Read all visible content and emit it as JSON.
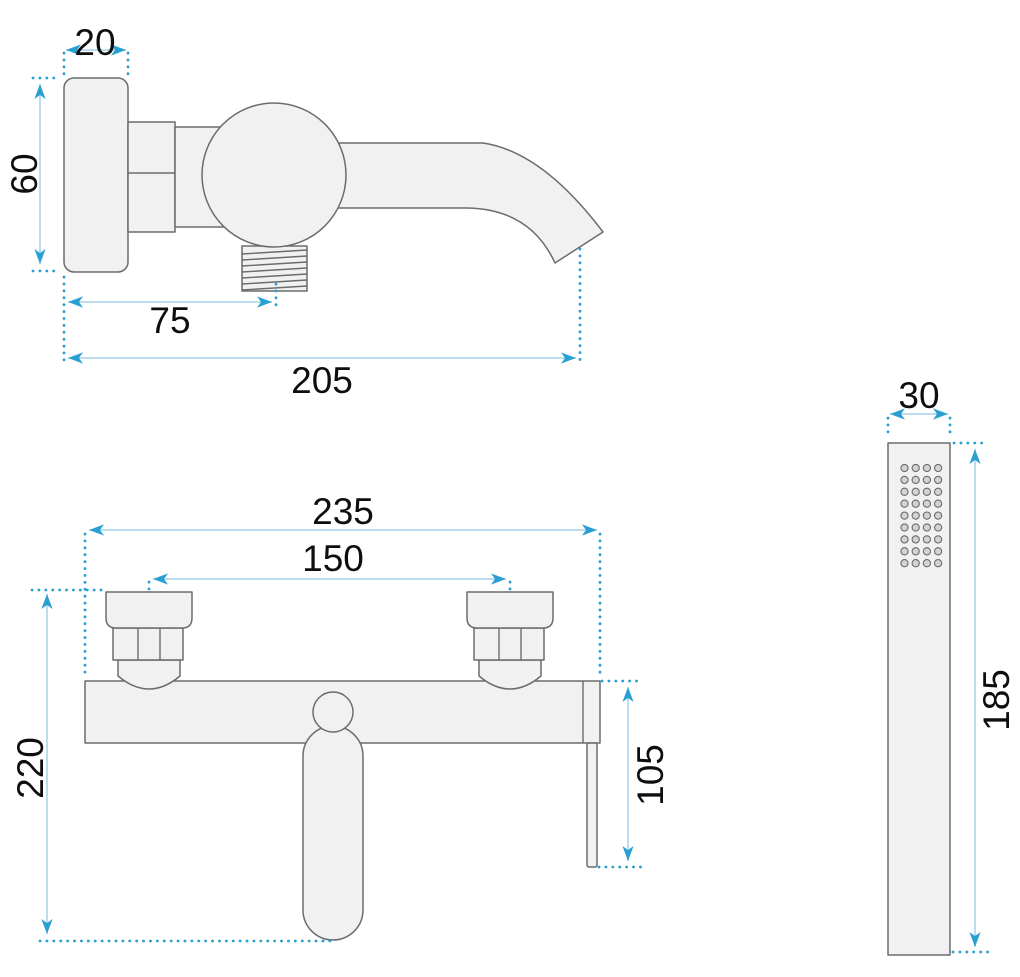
{
  "diagram": {
    "type": "technical-drawing",
    "side_view": {
      "dims": {
        "plate_depth": "20",
        "plate_height": "60",
        "outlet_offset": "75",
        "spout_reach": "205"
      }
    },
    "front_view": {
      "dims": {
        "overall_width": "235",
        "connection_centers": "150",
        "overall_height": "220",
        "lever_drop": "105"
      }
    },
    "hand_shower": {
      "dims": {
        "width": "30",
        "length": "185"
      }
    },
    "colors": {
      "dimension_accent": "#2aa0d2",
      "dimension_line": "#a3d2ea",
      "outline": "#6b6c6e",
      "part_fill": "#f1f1f2",
      "label_text": "#0e0e0e",
      "background": "#ffffff"
    }
  }
}
